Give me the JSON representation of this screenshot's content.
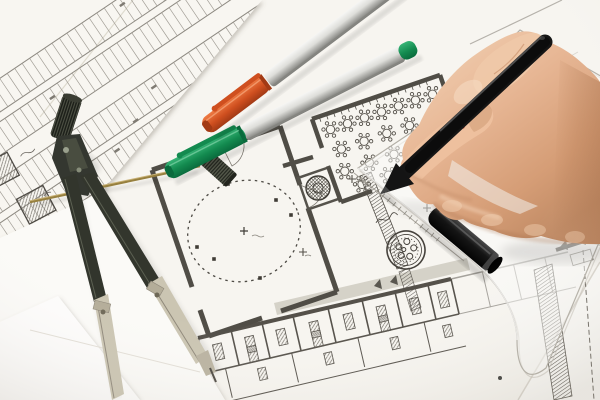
{
  "scene": {
    "type": "photograph",
    "subject": "architect hand drawing on blueprints",
    "objects": [
      {
        "name": "hand-with-pen",
        "description": "right hand holding a black fineliner pen, drawing along a transparent set square"
      },
      {
        "name": "drawing-compass",
        "description": "metal drafting compass with knurled knob, legs spread open on the plans"
      },
      {
        "name": "orange-cap-pen",
        "description": "white-bodied marker pen with orange cap, lying diagonally"
      },
      {
        "name": "green-cap-pen",
        "description": "white-bodied marker pen with green cap and green end plug, lying diagonally"
      },
      {
        "name": "black-pen-cap",
        "description": "black pen cap lying on the transparent set square"
      },
      {
        "name": "set-square",
        "description": "transparent plastic triangle with graduated edge and rounded corner"
      },
      {
        "name": "blueprints",
        "description": "several overlapping architectural sheets: parking site plan, floor plan with round tables, dashed circular room, corridor with hatched furniture, round architect seal stamp"
      },
      {
        "name": "lead-case",
        "description": "small knurled cylinder (compass lead case) on the paper"
      },
      {
        "name": "brass-rod",
        "description": "thin brass extension bar lying under the compass"
      }
    ]
  },
  "colors": {
    "paper_bg": "#e6e2da",
    "sheet_plan": "#f7f5f0",
    "sheet_parking": "#f8f6f1",
    "sheet_blank": "#fbfaf7",
    "sheet_blank2": "#fdfcfb",
    "sheet_corner": "#faf9f5",
    "plan_ink": "#55514a",
    "plan_light": "#8e8a82",
    "plan_gray": "#c9c5bb",
    "wall_dark": "#504d46",
    "pen_body_light": "#f6f6f4",
    "pen_body_mid": "#dededa",
    "pen_body_dark": "#8e8e8a",
    "cap_green": "#138a4f",
    "cap_green_light": "#37b476",
    "cap_green_dark": "#0a6b3d",
    "cap_orange": "#cf4f1f",
    "cap_orange_light": "#ef7b44",
    "cap_orange_dark": "#a23a15",
    "pen_black": "#151515",
    "pen_black_hi": "#5e5e5e",
    "compass_dark": "#343730",
    "compass_mid": "#4a4e42",
    "compass_metal": "#cbc5b2",
    "compass_metal_dark": "#8f887a",
    "brass": "#97803f",
    "skin_light": "#f4d6ba",
    "skin_mid": "#e7b694",
    "skin_dark": "#c08a64",
    "skin_shadow": "#a8714e",
    "triangle_edge": "#b3afa6",
    "stamp_ink": "#46423c"
  },
  "gen": {
    "tables": [
      [
        330.5,
        129.5
      ],
      [
        347.5,
        123.6
      ],
      [
        364.5,
        117.8
      ],
      [
        381.5,
        111.9
      ],
      [
        398.5,
        106.0
      ],
      [
        415.5,
        100.2
      ],
      [
        432.5,
        94.3
      ],
      [
        341.4,
        149.0
      ],
      [
        364.1,
        141.2
      ],
      [
        386.8,
        133.4
      ],
      [
        409.5,
        125.5
      ],
      [
        432.2,
        117.7
      ],
      [
        344.8,
        171.2
      ],
      [
        369.4,
        162.7
      ],
      [
        394.0,
        154.3
      ],
      [
        418.6,
        145.8
      ],
      [
        362.0,
        184.3
      ],
      [
        388.5,
        175.2
      ]
    ],
    "wall_ticks": {
      "x": 312.5,
      "y": 120.5,
      "dx": 7.1,
      "dy": -2.45,
      "n": 17,
      "tx": 1.3,
      "ty": 3.8
    },
    "tri_ticks": {
      "x": 363,
      "y": 176,
      "dx": 5.46,
      "dy": 4.37,
      "n": 15,
      "tx": -3.1,
      "ty": 3.9
    },
    "park": {
      "bands": [
        8,
        44,
        92,
        128
      ],
      "h": 28,
      "x0": -80,
      "x1": 290,
      "step": 9
    },
    "park_blobs": [
      [
        -20,
        20
      ],
      [
        40,
        52
      ],
      [
        130,
        100
      ],
      [
        206,
        22
      ],
      [
        64,
        132
      ],
      [
        246,
        60
      ],
      [
        150,
        14
      ],
      [
        96,
        118
      ]
    ],
    "circle_dots": [
      [
        291,
        215
      ],
      [
        197,
        247
      ],
      [
        260,
        278
      ],
      [
        228,
        184
      ],
      [
        214,
        259
      ],
      [
        276,
        200
      ]
    ],
    "corridor": {
      "dv": [
        8.1,
        35.1
      ],
      "parts": [
        [
          198,
          338
        ],
        [
          231,
          330
        ],
        [
          262,
          323
        ],
        [
          293,
          316
        ],
        [
          328,
          308
        ],
        [
          362,
          300
        ],
        [
          395,
          292
        ],
        [
          428,
          285
        ],
        [
          451,
          279
        ]
      ],
      "furn": [
        [
          218.6,
          351.7
        ],
        [
          250.7,
          344.2
        ],
        [
          281.9,
          337.0
        ],
        [
          315,
          329.3
        ],
        [
          349.1,
          321.4
        ],
        [
          382.2,
          313.7
        ],
        [
          415.3,
          306.0
        ],
        [
          443.6,
          299.5
        ],
        [
          252.9,
          354.0
        ],
        [
          317.2,
          339.0
        ],
        [
          384.4,
          323.5
        ]
      ],
      "dv2": [
        6.8,
        29.2
      ],
      "parts2": [
        [
          225.5,
          368.5
        ],
        [
          291.7,
          353.2
        ],
        [
          357.9,
          337.8
        ],
        [
          424.1,
          322.5
        ]
      ],
      "furn2": [
        [
          262.6,
          373.8
        ],
        [
          328.9,
          358.4
        ],
        [
          395.1,
          343.1
        ],
        [
          447.7,
          330.9
        ]
      ],
      "ext_parts": [
        [
          482.4,
          272.0
        ],
        [
          513.6,
          264.8
        ],
        [
          544.8,
          257.6
        ]
      ]
    }
  }
}
